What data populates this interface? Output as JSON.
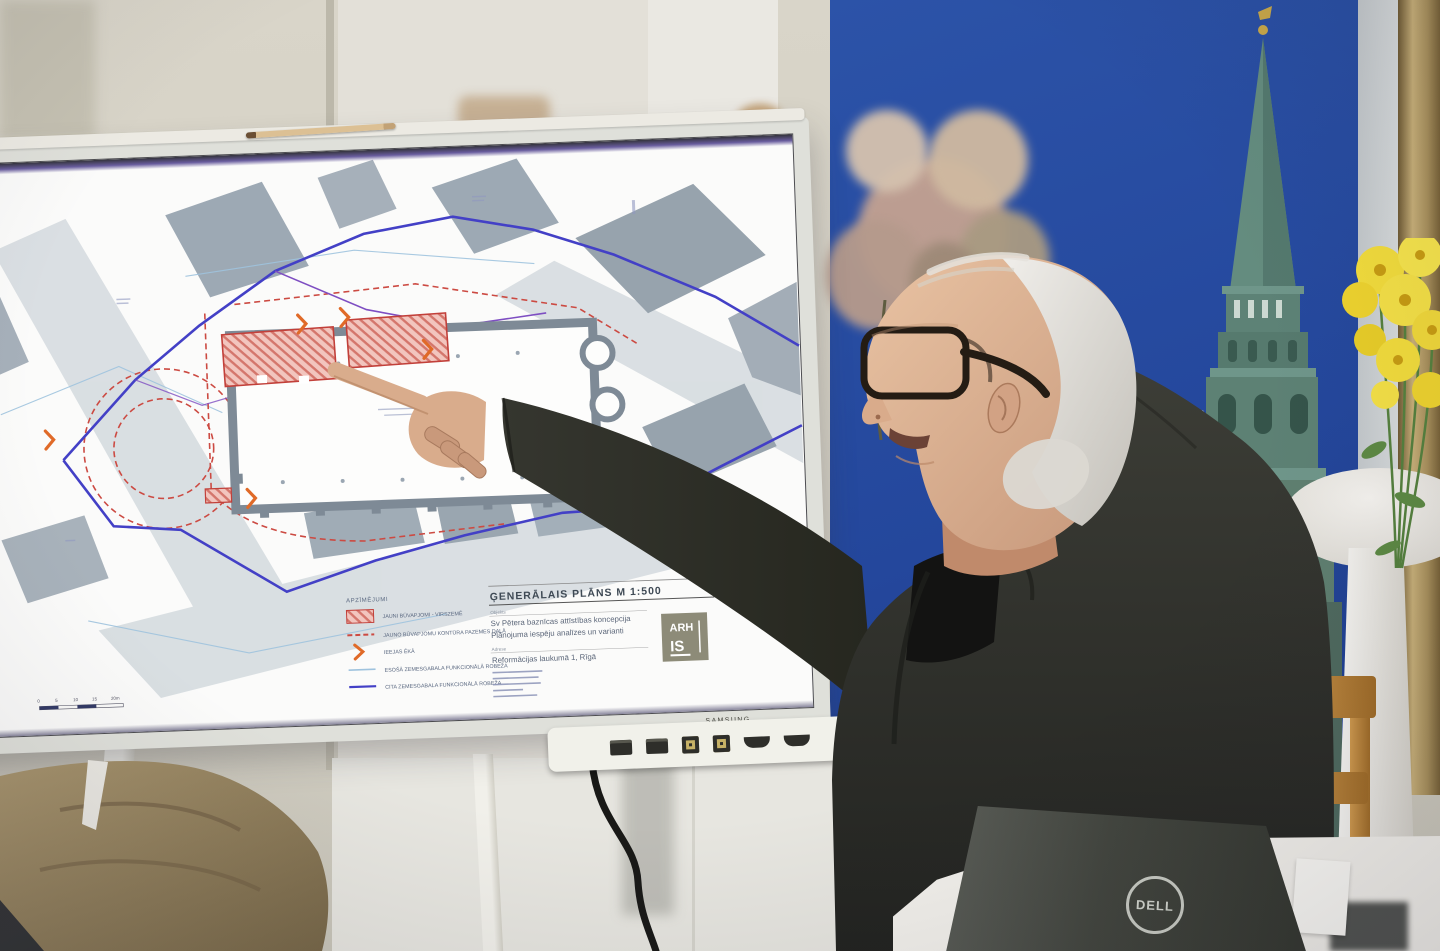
{
  "screen": {
    "brand_label": "SAMSUNG",
    "plan": {
      "title": "ĢENERĀLAIS PLĀNS  M 1:500",
      "legend": {
        "heading": "APZĪMĒJUMI",
        "items": [
          {
            "swatch": "red-hatch-area",
            "label": "JAUNI BŪVAPJOMI - VIRSZEMĒ"
          },
          {
            "swatch": "red-dashed-line",
            "label": "JAUNO BŪVAPJOMU KONTŪRA PAZEMES DAĻĀ"
          },
          {
            "swatch": "orange-chevron",
            "label": "IEEJAS ĒKĀ"
          },
          {
            "swatch": "light-blue-line",
            "label": "ESOŠĀ ZEMESGABALA FUNKCIONĀLĀ ROBEŽA"
          },
          {
            "swatch": "blue-line",
            "label": "CITA ZEMESGABALA FUNKCIONĀLĀ ROBEŽA"
          }
        ]
      },
      "titleblock": {
        "object_label": "Objekts",
        "object_line1": "Sv Pētera baznīcas attīstības koncepcija",
        "object_line2": "Plānojuma iespēju analīzes un varianti",
        "address_label": "Adrese",
        "address_line": "Reformācijas laukumā 1, Rīgā",
        "logo_top": "ARH",
        "logo_bottom": "IS"
      },
      "scalebar_ticks": [
        "0",
        "5",
        "10",
        "15",
        "20m"
      ]
    }
  },
  "laptop": {
    "brand_label": "DELL"
  },
  "banner": {
    "partial_letter": "A"
  },
  "colors": {
    "banner_blue": "#2a4fa3",
    "plan_boundary_blue": "#4340c6",
    "new_volume_red": "#d05048",
    "building_gray": "#9da9b4",
    "spire_green": "#5d8478",
    "jacket_charcoal": "#31322c",
    "chair_wood": "#bf8a3f",
    "flower_yellow": "#f0d83a"
  }
}
